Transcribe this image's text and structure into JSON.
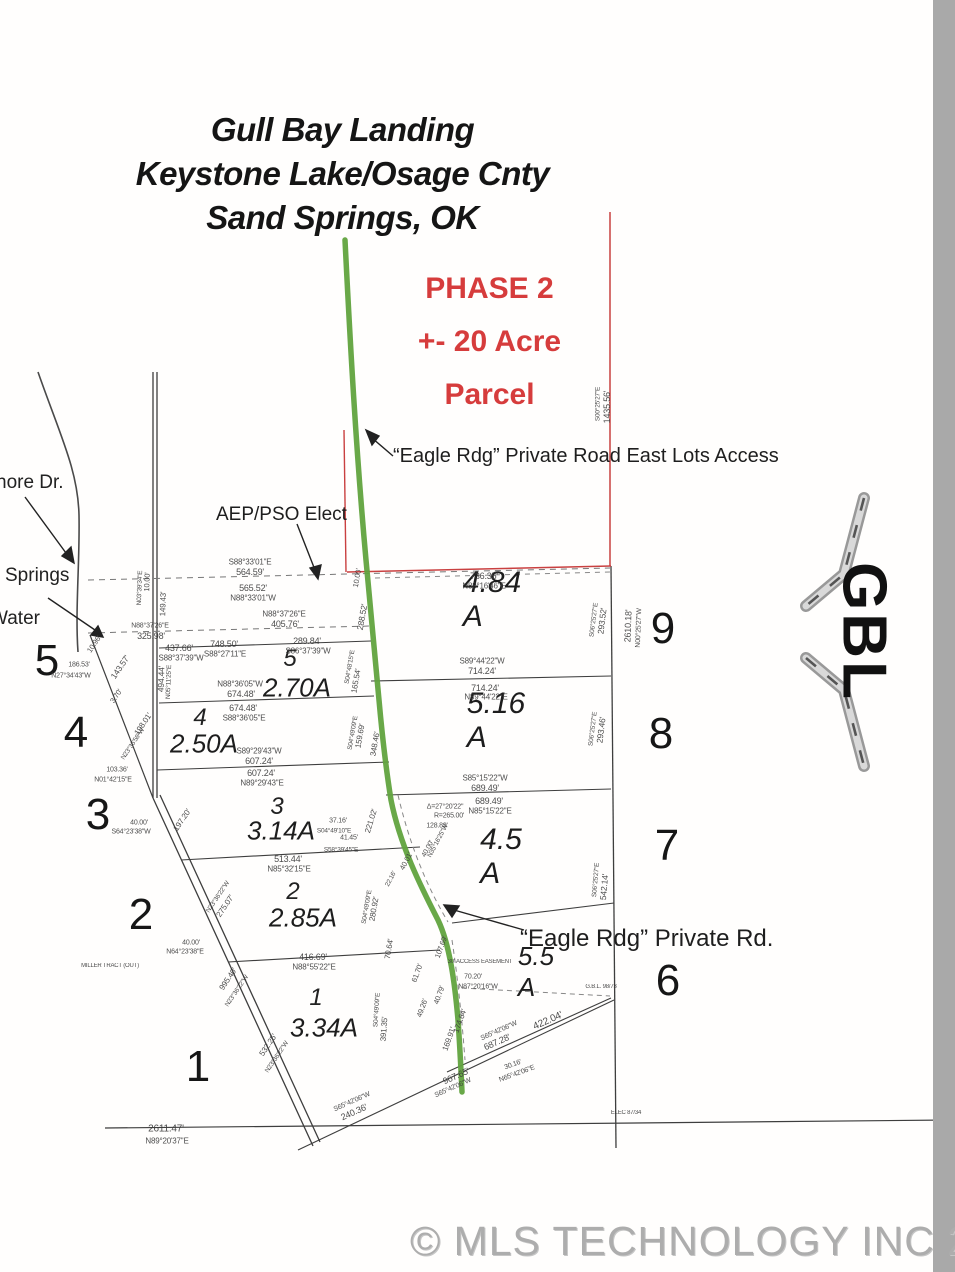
{
  "map": {
    "title_lines": [
      "Gull Bay Landing",
      "Keystone Lake/Osage Cnty",
      "Sand Springs, OK"
    ],
    "phase_lines": [
      "PHASE 2",
      "+- 20 Acre",
      "Parcel"
    ],
    "annotations": {
      "east_access": "“Eagle Rdg” Private Road East Lots Access",
      "private_rd": "“Eagle Rdg” Private Rd.",
      "utility": "AEP/PSO Elect",
      "street_partial_1": "nore Dr.",
      "street_partial_2": "Springs",
      "street_partial_3": "Water"
    },
    "lot_numbers_outer": [
      {
        "t": "5",
        "x": 47,
        "y": 661
      },
      {
        "t": "4",
        "x": 76,
        "y": 733
      },
      {
        "t": "3",
        "x": 98,
        "y": 815
      },
      {
        "t": "2",
        "x": 141,
        "y": 915
      },
      {
        "t": "1",
        "x": 198,
        "y": 1067
      },
      {
        "t": "9",
        "x": 663,
        "y": 629
      },
      {
        "t": "8",
        "x": 661,
        "y": 734
      },
      {
        "t": "7",
        "x": 667,
        "y": 846
      },
      {
        "t": "6",
        "x": 668,
        "y": 981
      }
    ],
    "lot_numbers_inner": [
      {
        "t": "5",
        "x": 290,
        "y": 659
      },
      {
        "t": "4",
        "x": 200,
        "y": 718
      },
      {
        "t": "3",
        "x": 277,
        "y": 807
      },
      {
        "t": "2",
        "x": 293,
        "y": 892
      },
      {
        "t": "1",
        "x": 316,
        "y": 998
      }
    ],
    "acreage_labels": [
      {
        "t": "2.70A",
        "x": 297,
        "y": 688,
        "s": 26
      },
      {
        "t": "2.50A",
        "x": 204,
        "y": 744,
        "s": 26
      },
      {
        "t": "3.14A",
        "x": 281,
        "y": 831,
        "s": 26
      },
      {
        "t": "2.85A",
        "x": 303,
        "y": 918,
        "s": 26
      },
      {
        "t": "3.34A",
        "x": 324,
        "y": 1028,
        "s": 26
      },
      {
        "t": "4.84 A",
        "x": 492,
        "y": 600,
        "s": 30
      },
      {
        "t": "5.16 A",
        "x": 496,
        "y": 721,
        "s": 30
      },
      {
        "t": "4.5 A",
        "x": 501,
        "y": 857,
        "s": 30
      },
      {
        "t": "5.5 A",
        "x": 536,
        "y": 972,
        "s": 26
      }
    ],
    "dim_labels": [
      {
        "t": "S88°33'01\"E",
        "x": 250,
        "y": 562,
        "s": 8
      },
      {
        "t": "564.59'",
        "x": 250,
        "y": 572,
        "s": 9
      },
      {
        "t": "565.52'",
        "x": 253,
        "y": 588,
        "s": 9
      },
      {
        "t": "N88°33'01\"W",
        "x": 253,
        "y": 598,
        "s": 8
      },
      {
        "t": "N88°37'26\"E",
        "x": 284,
        "y": 614,
        "s": 8
      },
      {
        "t": "405.76'",
        "x": 285,
        "y": 624,
        "s": 9
      },
      {
        "t": "N88°37'26\"E",
        "x": 150,
        "y": 626,
        "s": 7
      },
      {
        "t": "325.98'",
        "x": 151,
        "y": 636,
        "s": 9
      },
      {
        "t": "437.66'",
        "x": 179,
        "y": 648,
        "s": 9
      },
      {
        "t": "S88°37'39\"W",
        "x": 181,
        "y": 658,
        "s": 8
      },
      {
        "t": "748.50'",
        "x": 224,
        "y": 644,
        "s": 9
      },
      {
        "t": "S88°27'11\"E",
        "x": 225,
        "y": 654,
        "s": 8
      },
      {
        "t": "289.84'",
        "x": 307,
        "y": 641,
        "s": 9
      },
      {
        "t": "S86°37'39\"W",
        "x": 308,
        "y": 651,
        "s": 8
      },
      {
        "t": "N88°36'05\"W",
        "x": 240,
        "y": 684,
        "s": 8
      },
      {
        "t": "674.48'",
        "x": 241,
        "y": 694,
        "s": 9
      },
      {
        "t": "674.48'",
        "x": 243,
        "y": 708,
        "s": 9
      },
      {
        "t": "S88°36'05\"E",
        "x": 244,
        "y": 718,
        "s": 8
      },
      {
        "t": "S89°29'43\"W",
        "x": 259,
        "y": 751,
        "s": 8
      },
      {
        "t": "607.24'",
        "x": 259,
        "y": 761,
        "s": 9
      },
      {
        "t": "607.24'",
        "x": 261,
        "y": 773,
        "s": 9
      },
      {
        "t": "N89°29'43\"E",
        "x": 262,
        "y": 783,
        "s": 8
      },
      {
        "t": "513.44'",
        "x": 288,
        "y": 859,
        "s": 9
      },
      {
        "t": "N85°32'15\"E",
        "x": 289,
        "y": 869,
        "s": 8
      },
      {
        "t": "416.69'",
        "x": 313,
        "y": 957,
        "s": 9
      },
      {
        "t": "N88°55'22\"E",
        "x": 314,
        "y": 967,
        "s": 8
      },
      {
        "t": "736.35'",
        "x": 484,
        "y": 576,
        "s": 9
      },
      {
        "t": "N88°16'46\"E",
        "x": 484,
        "y": 586,
        "s": 8
      },
      {
        "t": "S89°44'22\"W",
        "x": 482,
        "y": 661,
        "s": 8
      },
      {
        "t": "714.24'",
        "x": 482,
        "y": 671,
        "s": 9
      },
      {
        "t": "714.24'",
        "x": 485,
        "y": 688,
        "s": 9
      },
      {
        "t": "N89°44'22\"E",
        "x": 486,
        "y": 697,
        "s": 8
      },
      {
        "t": "S85°15'22\"W",
        "x": 485,
        "y": 778,
        "s": 8
      },
      {
        "t": "689.49'",
        "x": 485,
        "y": 788,
        "s": 9
      },
      {
        "t": "689.49'",
        "x": 489,
        "y": 801,
        "s": 9
      },
      {
        "t": "N85°15'22\"E",
        "x": 490,
        "y": 811,
        "s": 8
      },
      {
        "t": "Δ=27°20'22\"",
        "x": 445,
        "y": 807,
        "s": 7
      },
      {
        "t": "R=265.00'",
        "x": 449,
        "y": 816,
        "s": 7
      },
      {
        "t": "128.89'",
        "x": 437,
        "y": 826,
        "s": 7
      },
      {
        "t": "2611.47'",
        "x": 166,
        "y": 1129,
        "s": 10
      },
      {
        "t": "N89°20'37\"E",
        "x": 167,
        "y": 1141,
        "s": 8
      },
      {
        "t": "186.53'",
        "x": 79,
        "y": 665,
        "s": 7
      },
      {
        "t": "N27°34'43\"W",
        "x": 71,
        "y": 676,
        "s": 7
      },
      {
        "t": "103.36'",
        "x": 117,
        "y": 770,
        "s": 7
      },
      {
        "t": "N01°42'15\"E",
        "x": 113,
        "y": 780,
        "s": 7
      },
      {
        "t": "40.00'",
        "x": 139,
        "y": 823,
        "s": 7
      },
      {
        "t": "S64°23'38\"W",
        "x": 131,
        "y": 832,
        "s": 7
      },
      {
        "t": "40.00'",
        "x": 191,
        "y": 943,
        "s": 7
      },
      {
        "t": "N64°23'38\"E",
        "x": 185,
        "y": 952,
        "s": 7
      },
      {
        "t": "MILLER TRACT (OUT)",
        "x": 110,
        "y": 966,
        "s": 6
      },
      {
        "t": "30' ACCESS EASEMENT",
        "x": 480,
        "y": 962,
        "s": 6
      },
      {
        "t": "70.20'",
        "x": 473,
        "y": 977,
        "s": 7
      },
      {
        "t": "N87°20'16\"W",
        "x": 478,
        "y": 987,
        "s": 7
      },
      {
        "t": "37.16'",
        "x": 338,
        "y": 821,
        "s": 7
      },
      {
        "t": "S04°49'10\"E",
        "x": 334,
        "y": 831,
        "s": 6.5
      },
      {
        "t": "41.45'",
        "x": 349,
        "y": 838,
        "s": 7
      },
      {
        "t": "S58°39'45\"E",
        "x": 341,
        "y": 850,
        "s": 6.5
      },
      {
        "t": "30.16'",
        "x": 513,
        "y": 1065,
        "s": 7,
        "r": -20
      },
      {
        "t": "N65°42'06\"E",
        "x": 517,
        "y": 1074,
        "s": 7,
        "r": -20
      },
      {
        "t": "G.B.L. 98/73",
        "x": 601,
        "y": 987,
        "s": 6
      },
      {
        "t": "ELEC 87/34",
        "x": 626,
        "y": 1113,
        "s": 6
      },
      {
        "t": "1435.56'",
        "x": 607,
        "y": 407,
        "s": 9,
        "r": -90
      },
      {
        "t": "S00°25'27\"E",
        "x": 598,
        "y": 404,
        "s": 6.5,
        "r": -90
      },
      {
        "t": "293.52'",
        "x": 602,
        "y": 621,
        "s": 8.5,
        "r": -83
      },
      {
        "t": "S06°25'27\"E",
        "x": 594,
        "y": 620,
        "s": 6.5,
        "r": -83
      },
      {
        "t": "2610.18'",
        "x": 628,
        "y": 626,
        "s": 9,
        "r": -88
      },
      {
        "t": "N00°25'27\"W",
        "x": 639,
        "y": 628,
        "s": 7,
        "r": -88
      },
      {
        "t": "293.46'",
        "x": 601,
        "y": 730,
        "s": 8.5,
        "r": -83
      },
      {
        "t": "S06°25'27\"E",
        "x": 593,
        "y": 729,
        "s": 6.5,
        "r": -83
      },
      {
        "t": "542.14'",
        "x": 604,
        "y": 887,
        "s": 8.5,
        "r": -85
      },
      {
        "t": "S06°25'27\"E",
        "x": 596,
        "y": 880,
        "s": 6.5,
        "r": -85
      },
      {
        "t": "10.00'",
        "x": 357,
        "y": 578,
        "s": 7.5,
        "r": -80
      },
      {
        "t": "288.52'",
        "x": 362,
        "y": 617,
        "s": 8.5,
        "r": -80
      },
      {
        "t": "165.54'",
        "x": 356,
        "y": 681,
        "s": 8,
        "r": -80
      },
      {
        "t": "S04°48'15\"E",
        "x": 350,
        "y": 667,
        "s": 6.5,
        "r": -80
      },
      {
        "t": "159.69'",
        "x": 360,
        "y": 736,
        "s": 8,
        "r": -80
      },
      {
        "t": "S04°49'09\"E",
        "x": 353,
        "y": 733,
        "s": 6.5,
        "r": -80
      },
      {
        "t": "348.46'",
        "x": 375,
        "y": 744,
        "s": 8,
        "r": -80
      },
      {
        "t": "221.02'",
        "x": 371,
        "y": 821,
        "s": 8,
        "r": -73
      },
      {
        "t": "N23°36'22\"W",
        "x": 218,
        "y": 897,
        "s": 6.5,
        "r": -56
      },
      {
        "t": "275.07'",
        "x": 225,
        "y": 906,
        "s": 8,
        "r": -56
      },
      {
        "t": "995.40'",
        "x": 228,
        "y": 979,
        "s": 8,
        "r": -56
      },
      {
        "t": "N23°36'22\"W",
        "x": 237,
        "y": 991,
        "s": 6.5,
        "r": -56
      },
      {
        "t": "532.25'",
        "x": 268,
        "y": 1045,
        "s": 8,
        "r": -56
      },
      {
        "t": "N23°36'22\"W",
        "x": 277,
        "y": 1057,
        "s": 6.5,
        "r": -56
      },
      {
        "t": "197.20'",
        "x": 182,
        "y": 820,
        "s": 8,
        "r": -56
      },
      {
        "t": "10.96'",
        "x": 94,
        "y": 644,
        "s": 7.5,
        "r": -56
      },
      {
        "t": "143.57'",
        "x": 120,
        "y": 667,
        "s": 8.5,
        "r": -56
      },
      {
        "t": "3.70'",
        "x": 116,
        "y": 696,
        "s": 7.5,
        "r": -56
      },
      {
        "t": "198.01'",
        "x": 143,
        "y": 724,
        "s": 8,
        "r": -56
      },
      {
        "t": "N23°36'58\"W",
        "x": 133,
        "y": 744,
        "s": 6.5,
        "r": -56
      },
      {
        "t": "494.44'",
        "x": 161,
        "y": 679,
        "s": 8.5,
        "r": -88
      },
      {
        "t": "N05°11'25\"E",
        "x": 169,
        "y": 682,
        "s": 6.5,
        "r": -88
      },
      {
        "t": "149.43'",
        "x": 163,
        "y": 604,
        "s": 8,
        "r": -88
      },
      {
        "t": "10.00'",
        "x": 147,
        "y": 582,
        "s": 7.5,
        "r": -88
      },
      {
        "t": "N03°39'34\"E",
        "x": 140,
        "y": 588,
        "s": 6.5,
        "r": -88
      },
      {
        "t": "280.92'",
        "x": 374,
        "y": 909,
        "s": 8,
        "r": -80
      },
      {
        "t": "S04°49'09\"E",
        "x": 367,
        "y": 907,
        "s": 6.5,
        "r": -80
      },
      {
        "t": "70.64'",
        "x": 389,
        "y": 949,
        "s": 8,
        "r": -80
      },
      {
        "t": "391.35'",
        "x": 384,
        "y": 1029,
        "s": 8,
        "r": -86
      },
      {
        "t": "S04°49'09\"E",
        "x": 377,
        "y": 1010,
        "s": 6.5,
        "r": -86
      },
      {
        "t": "107.69'",
        "x": 441,
        "y": 947,
        "s": 7.5,
        "r": -70
      },
      {
        "t": "61.70'",
        "x": 417,
        "y": 973,
        "s": 7.5,
        "r": -70
      },
      {
        "t": "40.79'",
        "x": 439,
        "y": 995,
        "s": 7.5,
        "r": -70
      },
      {
        "t": "49.26'",
        "x": 422,
        "y": 1008,
        "s": 7.5,
        "r": -70
      },
      {
        "t": "174.64'",
        "x": 460,
        "y": 1021,
        "s": 8,
        "r": -70
      },
      {
        "t": "169.91'",
        "x": 449,
        "y": 1039,
        "s": 8,
        "r": -70
      },
      {
        "t": "967.65'",
        "x": 456,
        "y": 1076,
        "s": 9,
        "r": -24
      },
      {
        "t": "S65°42'06\"W",
        "x": 453,
        "y": 1088,
        "s": 7,
        "r": -24
      },
      {
        "t": "S65°42'06\"W",
        "x": 499,
        "y": 1031,
        "s": 7,
        "r": -24
      },
      {
        "t": "687.28'",
        "x": 497,
        "y": 1042,
        "s": 9,
        "r": -24
      },
      {
        "t": "422.04'",
        "x": 548,
        "y": 1021,
        "s": 10,
        "r": -24
      },
      {
        "t": "S65°42'06\"W",
        "x": 352,
        "y": 1102,
        "s": 7,
        "r": -24
      },
      {
        "t": "240.36'",
        "x": 354,
        "y": 1112,
        "s": 9,
        "r": -24
      },
      {
        "t": "40.01'",
        "x": 406,
        "y": 861,
        "s": 7.5,
        "r": -62
      },
      {
        "t": "40.00'",
        "x": 428,
        "y": 849,
        "s": 7,
        "r": -62
      },
      {
        "t": "N35°16'25\"W",
        "x": 438,
        "y": 841,
        "s": 6.5,
        "r": -62
      },
      {
        "t": "22.16'",
        "x": 391,
        "y": 879,
        "s": 6.5,
        "r": -62
      }
    ]
  },
  "logo": {
    "text": "GBL"
  },
  "watermark": {
    "text": "© MLS TECHNOLOGY INC 2026"
  },
  "colors": {
    "phase_red": "#d63c3c",
    "boundary_red": "#c94040",
    "road_green": "#61a33e",
    "line_black": "#3e3e3e",
    "sidebar_gray": "#a9a9a9",
    "watermark_gray": "#adadad"
  }
}
